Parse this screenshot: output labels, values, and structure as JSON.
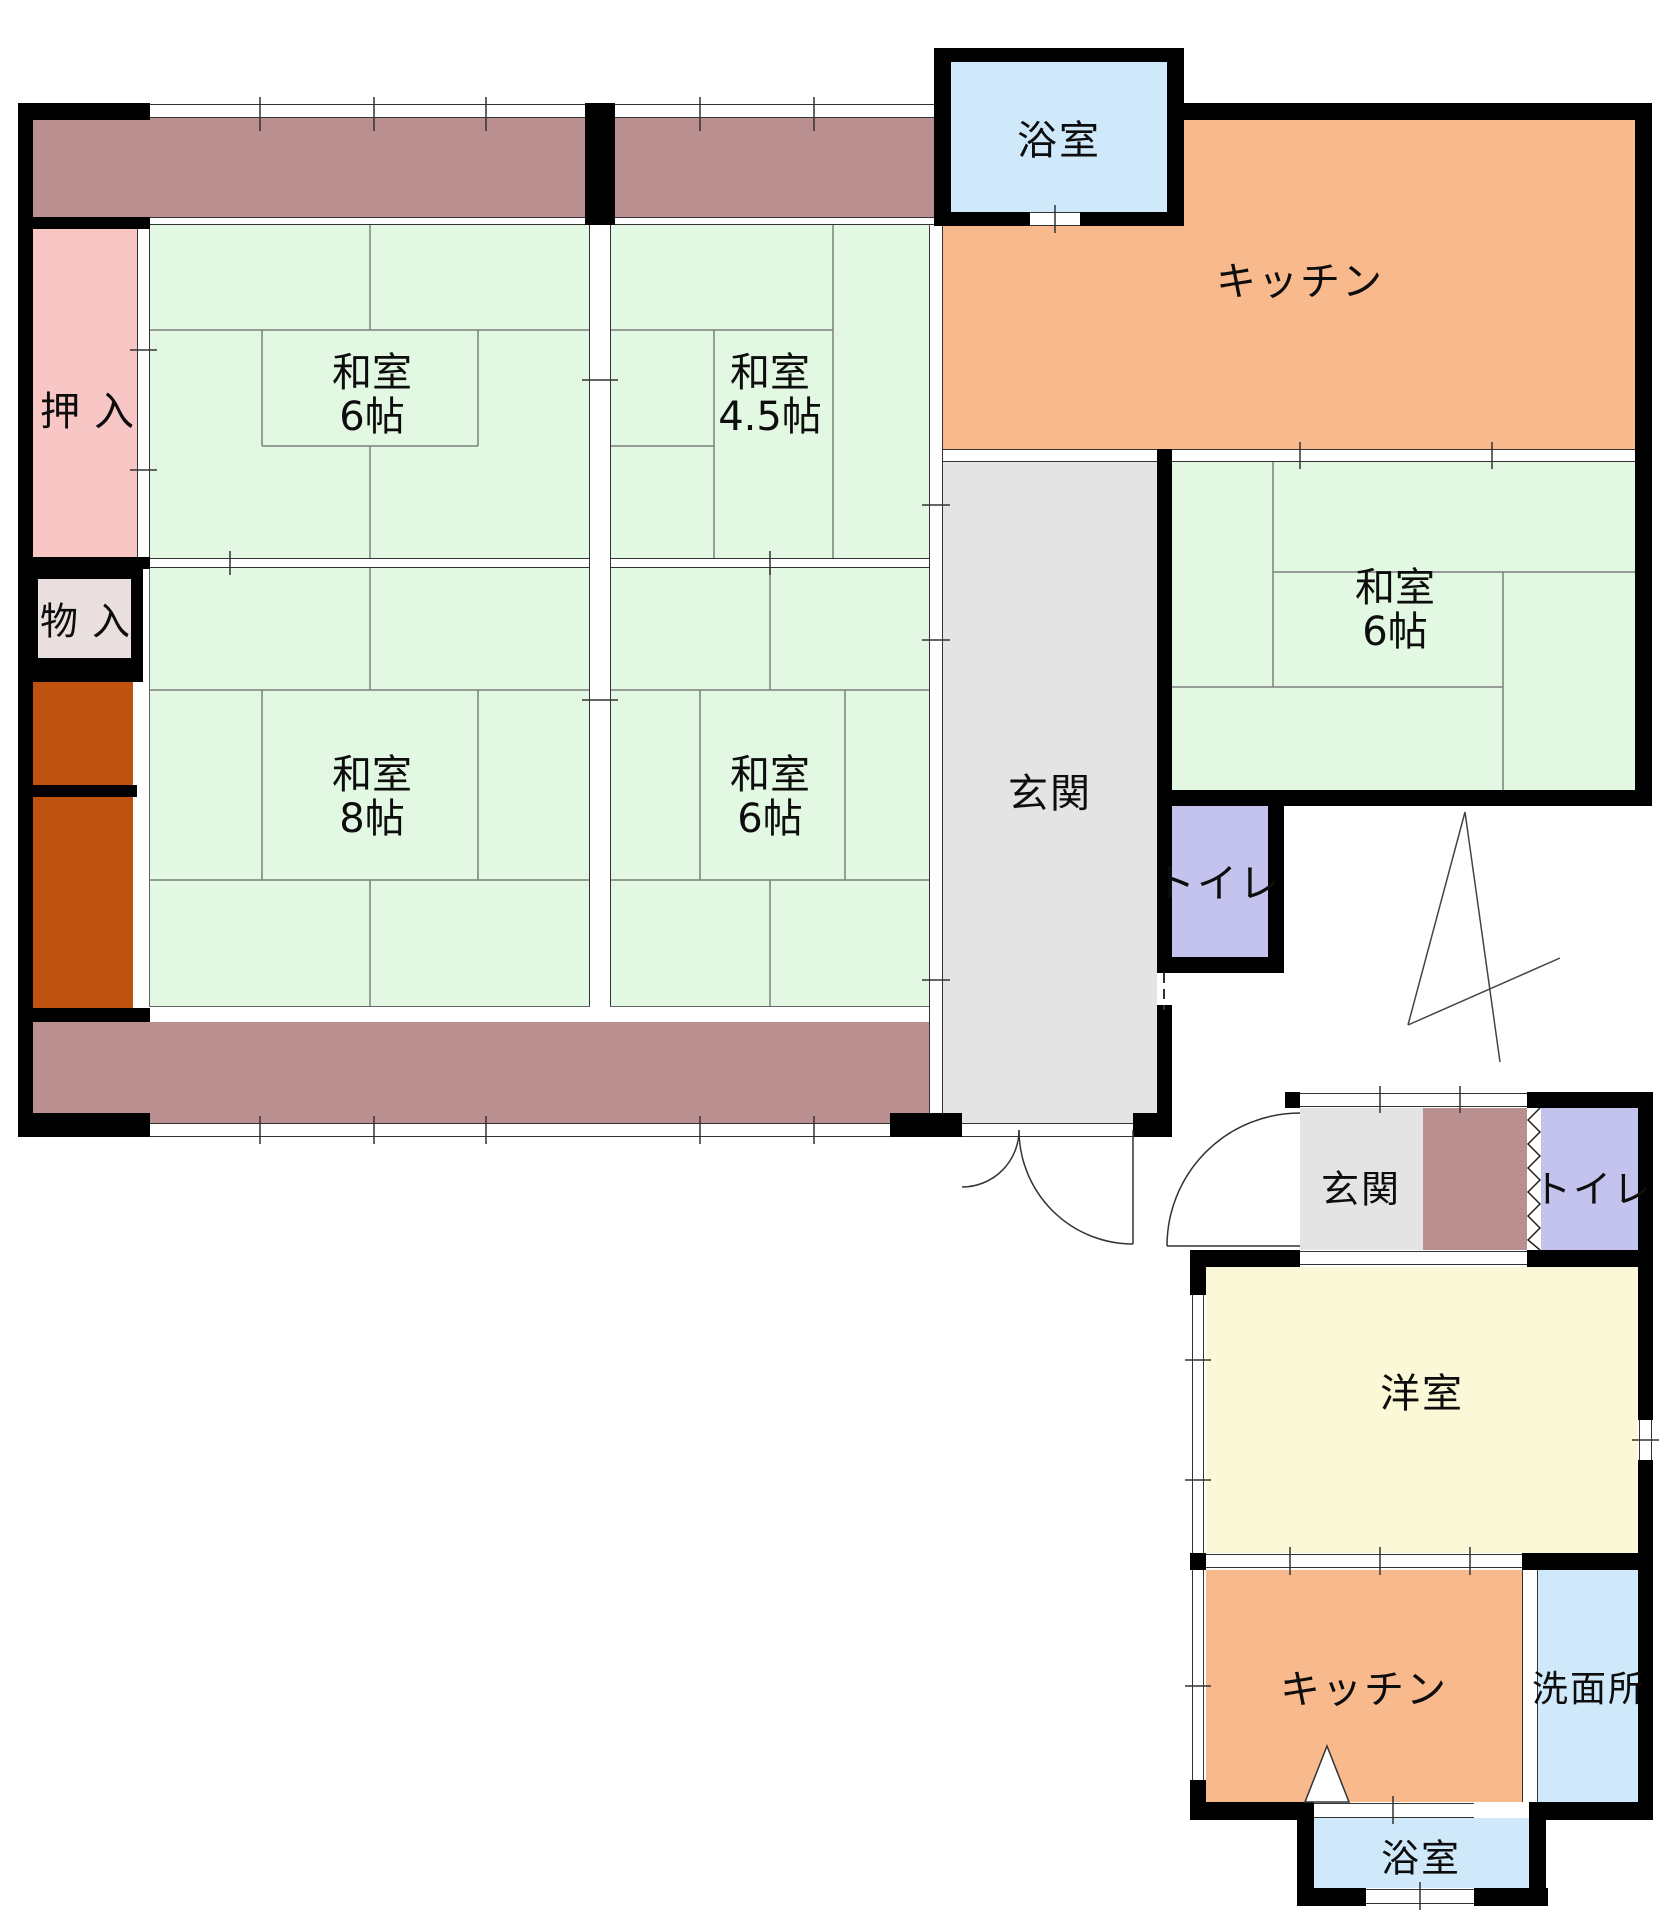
{
  "palette": {
    "wall": "#000000",
    "veranda_mauve": "#b98f8f",
    "closet_pink": "#f9c6c6",
    "storage_beige": "#eadfdf",
    "alcove_rust": "#c0520f",
    "tatami_green": "#e2f8e2",
    "genkan_gray": "#e4e4e4",
    "kitchen_orange": "#f8b98c",
    "bath_blue": "#cfe9fa",
    "toilet_purple": "#c3c3ee",
    "western_yellow": "#fbf8d7"
  },
  "main_unit": {
    "rooms": {
      "bath": {
        "label": "浴室"
      },
      "kitchen": {
        "label": "キッチン"
      },
      "oshiire": {
        "label": "押入"
      },
      "monoire": {
        "label": "物入"
      },
      "washitsu_nw": {
        "label": "和室",
        "size": "6帖"
      },
      "washitsu_ne": {
        "label": "和室",
        "size": "4.5帖"
      },
      "washitsu_sw": {
        "label": "和室",
        "size": "8帖"
      },
      "washitsu_se": {
        "label": "和室",
        "size": "6帖"
      },
      "washitsu_e": {
        "label": "和室",
        "size": "6帖"
      },
      "genkan": {
        "label": "玄関"
      },
      "toilet": {
        "label": "トイレ"
      }
    }
  },
  "annex_unit": {
    "rooms": {
      "genkan": {
        "label": "玄関"
      },
      "toilet": {
        "label": "トイレ"
      },
      "western_room": {
        "label": "洋室"
      },
      "kitchen": {
        "label": "キッチン"
      },
      "washroom": {
        "label": "洗面所"
      },
      "bath": {
        "label": "浴室"
      }
    }
  }
}
